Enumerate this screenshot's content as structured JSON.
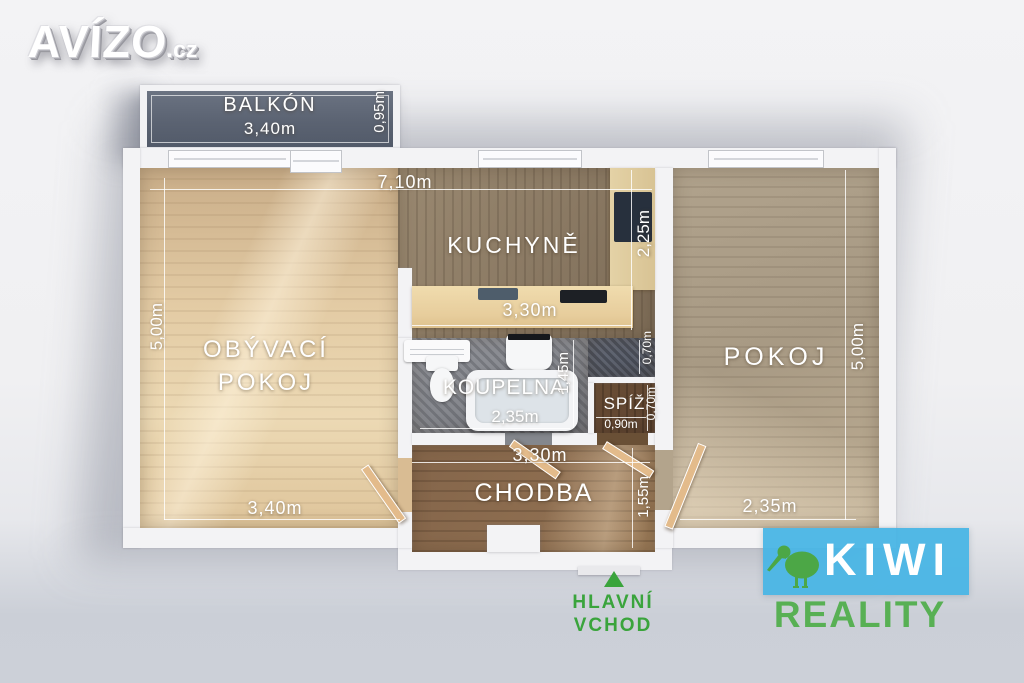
{
  "branding": {
    "avizo_text": "AVÍZO",
    "avizo_suffix": ".cz",
    "kiwi_line1": "KIWI",
    "kiwi_line2": "REALITY"
  },
  "entrance": {
    "line1": "HLAVNÍ",
    "line2": "VCHOD"
  },
  "dimensions": {
    "total_width": "7,10m"
  },
  "rooms": {
    "balkon": {
      "label": "BALKÓN",
      "width": "3,40m",
      "depth": "0,95m"
    },
    "obyvaci_pokoj": {
      "line1": "OBÝVACÍ",
      "line2": "POKOJ",
      "width": "3,40m",
      "height": "5,00m"
    },
    "kuchyne": {
      "label": "KUCHYNĚ",
      "width": "3,30m",
      "height": "2,25m"
    },
    "koupelna": {
      "label": "KOUPELNA",
      "width": "2,35m",
      "height": "1,45m",
      "niche_depth": "0,70m"
    },
    "spiz": {
      "label": "SPÍŽ",
      "width": "0,90m",
      "height": "0,70m"
    },
    "chodba": {
      "label": "CHODBA",
      "width": "3,30m",
      "height": "1,55m"
    },
    "pokoj": {
      "label": "POKOJ",
      "width": "2,35m",
      "height": "5,00m"
    }
  },
  "colors": {
    "entrance_green": "#3aa43c",
    "kiwi_blue": "#49b5e5",
    "kiwi_green": "#58b054",
    "balcony_floor": "#5b6372",
    "bathroom_floor": "#84868c"
  }
}
